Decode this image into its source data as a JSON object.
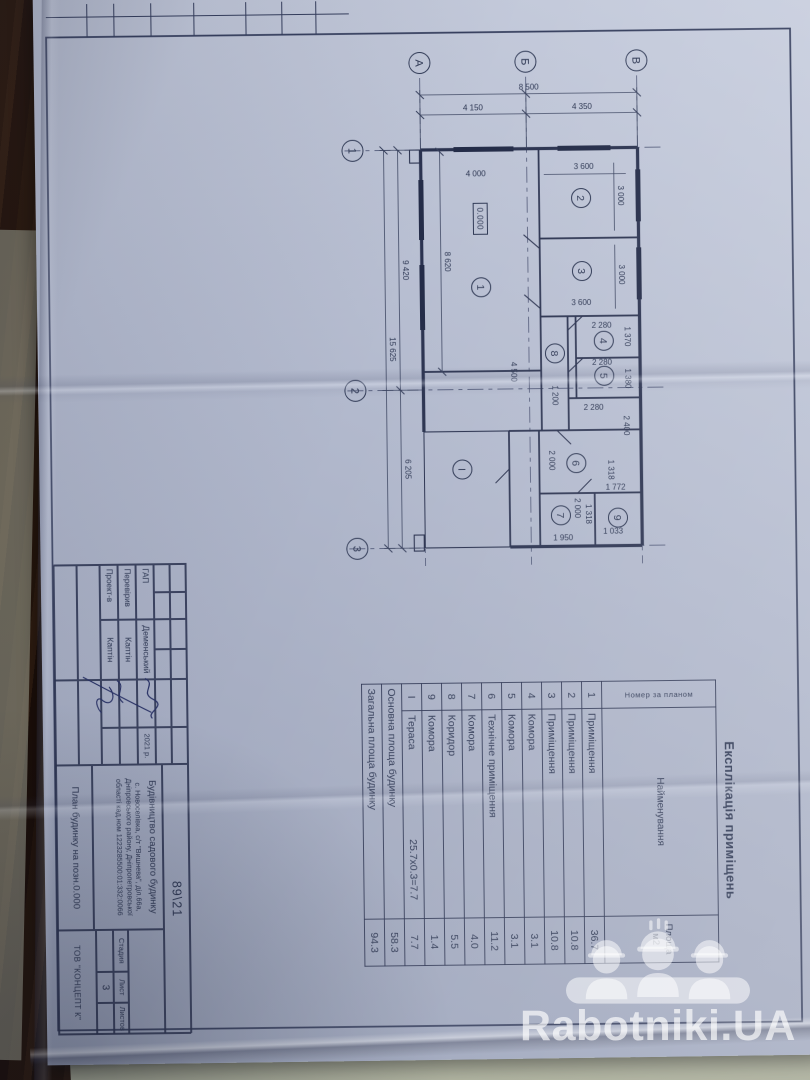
{
  "photo": {
    "watermark": {
      "brand": "Rabotniki.UA"
    }
  },
  "drawing": {
    "title_block": {
      "doc_no": "89\\21",
      "object": "Будівництво садового будинку",
      "address": "с. Новоселівка, с/т \"Вишнева\", діл.66а, Дніпровського району, Дніпропетровської області кад.ном 1223285500:01:332:0066",
      "signers": [
        {
          "role": "ГАП",
          "name": "Деменський"
        },
        {
          "role": "Перевірив",
          "name": "Каптін"
        },
        {
          "role": "Проект-в",
          "name": "Каптін"
        }
      ],
      "date": "2021 р.",
      "stage_label": "Стадия",
      "sheet_label": "Лист",
      "sheets_label": "Листов",
      "sheet_no": "3",
      "sheet_title": "План будинку на позн.0.000",
      "company": "ТОВ \"КОНЦЕПТ К\""
    },
    "explication": {
      "title": "Експлікація приміщень",
      "col_num": "Номер за планом",
      "col_name": "Найменування",
      "col_area_1": "Площа",
      "col_area_2": "м2",
      "rows": [
        {
          "num": "1",
          "name": "Приміщення",
          "area": "36.7"
        },
        {
          "num": "2",
          "name": "Приміщення",
          "area": "10.8"
        },
        {
          "num": "3",
          "name": "Приміщення",
          "area": "10.8"
        },
        {
          "num": "4",
          "name": "Комора",
          "area": "3.1"
        },
        {
          "num": "5",
          "name": "Комора",
          "area": "3.1"
        },
        {
          "num": "6",
          "name": "Технічне приміщення",
          "area": "11.2"
        },
        {
          "num": "7",
          "name": "Комора",
          "area": "4.0"
        },
        {
          "num": "8",
          "name": "Коридор",
          "area": "5.5"
        },
        {
          "num": "9",
          "name": "Комора",
          "area": "1.4"
        },
        {
          "num": "І",
          "name": "Тераса",
          "note": "25.7х0.3=7.7",
          "area": "7.7"
        },
        {
          "num": "",
          "name": "Основна площа будинку",
          "area": "58.3"
        },
        {
          "num": "",
          "name": "Загальна площа будинку",
          "area": "94.3"
        }
      ]
    },
    "plan": {
      "elevation": "0.000",
      "axis_letters": [
        "А",
        "Б",
        "В"
      ],
      "axis_numbers": [
        "1",
        "2",
        "3"
      ],
      "room_labels": [
        "1",
        "2",
        "3",
        "4",
        "5",
        "6",
        "7",
        "8",
        "9",
        "І"
      ],
      "dims": {
        "total_width": "15 625",
        "span_12": "9 420",
        "span_23": "6 205",
        "total_height": "8 500",
        "span_ab": "4 150",
        "span_bv": "4 350",
        "room1_w": "8 620",
        "room1_h": "4 000",
        "room2_w": "3 000",
        "room2_h": "3 600",
        "room3_w": "3 000",
        "room3_h": "3 600",
        "room4_w": "1 370",
        "room4_h": "2 280",
        "room5_w": "1 380",
        "room5_h": "2 280",
        "room6_w": "2 400",
        "room6_h": "2 280",
        "corridor_l": "4 500",
        "corridor_w": "1 200",
        "room7_w": "2 000",
        "room7_h": "1 950",
        "room9_w": "1 318",
        "room9_h": "1 033",
        "d_1318": "1 318",
        "d_1772": "1 772",
        "d_2000": "2 000"
      }
    }
  }
}
